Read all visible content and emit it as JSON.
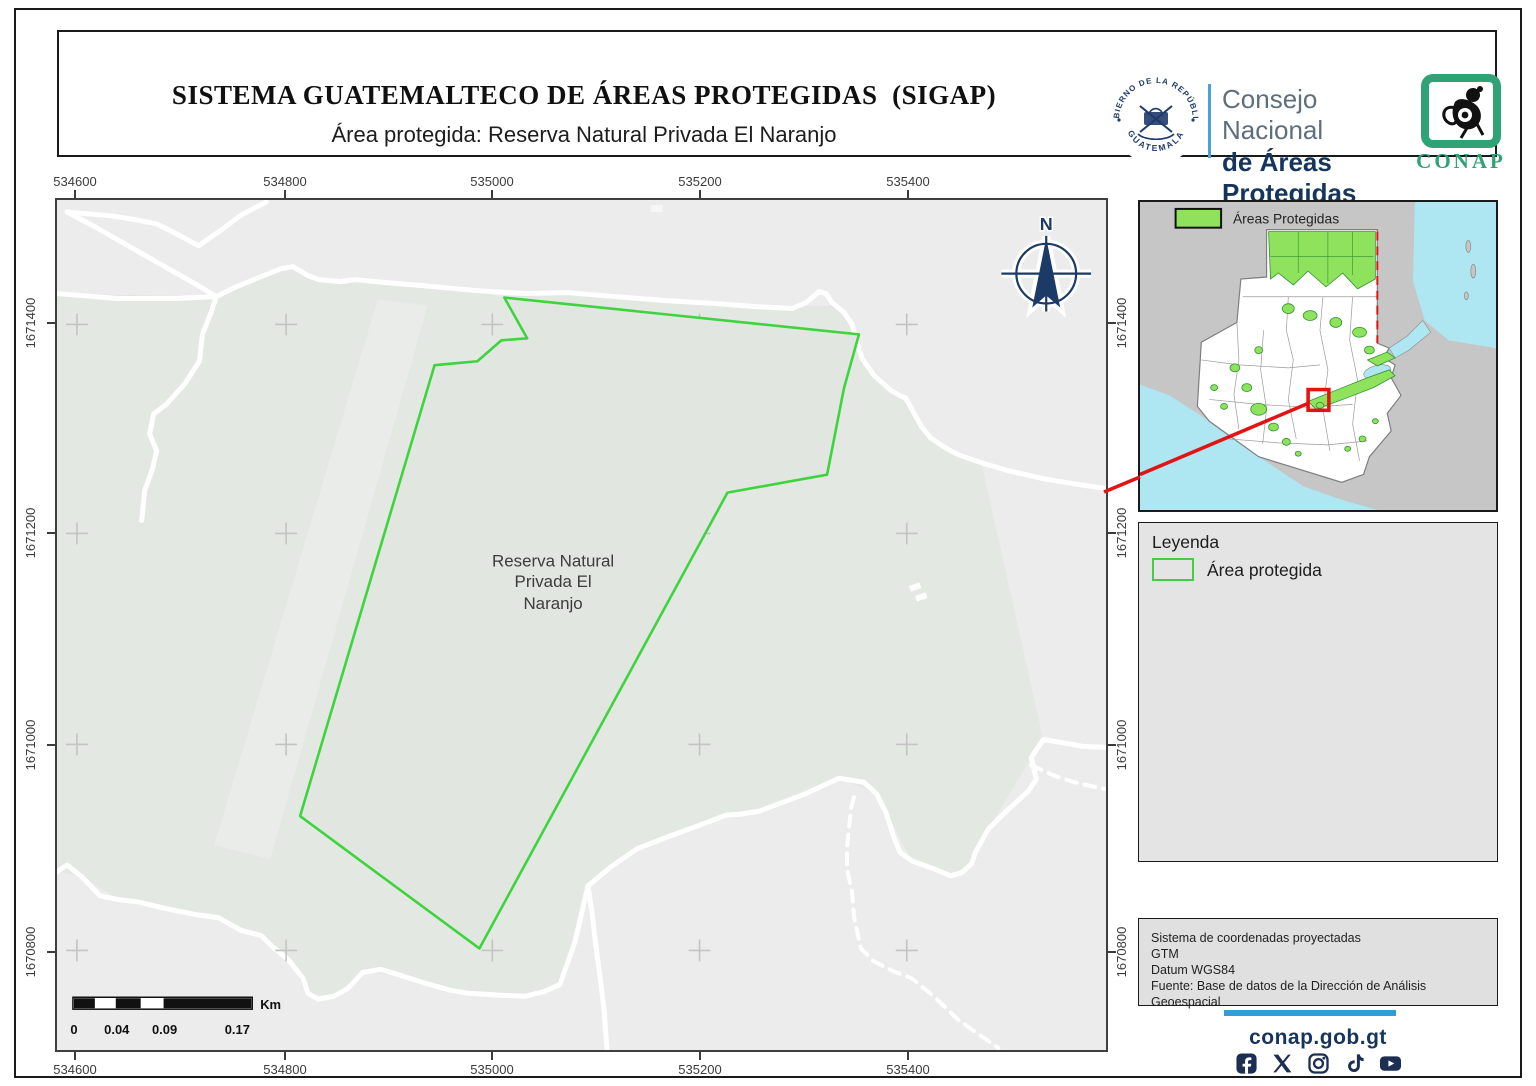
{
  "header": {
    "title": "SISTEMA GUATEMALTECO DE ÁREAS PROTEGIDAS  (SIGAP)",
    "subtitle": "Área protegida: Reserva Natural Privada El Naranjo",
    "seal": {
      "top": "GOBIERNO DE LA REPÚBLICA",
      "bottom": "GUATEMALA"
    },
    "org": {
      "line1": "Consejo Nacional",
      "line2": "de Áreas Protegidas",
      "line3": "Dirección de Análisis Geoespacial"
    },
    "conap": "CONAP"
  },
  "map": {
    "x_ticks": [
      "534600",
      "534800",
      "535000",
      "535200",
      "535400"
    ],
    "y_ticks": [
      "1671400",
      "1671200",
      "1671000",
      "1670800"
    ],
    "reserve_label": {
      "line1": "Reserva Natural",
      "line2": "Privada El",
      "line3": "Naranjo"
    },
    "north": "N",
    "scalebar": {
      "n0": "0",
      "n1": "0.04",
      "n2": "0.09",
      "n3": "0.17",
      "unit": "Km"
    }
  },
  "inset": {
    "legend": "Áreas Protegidas"
  },
  "legend_panel": {
    "title": "Leyenda",
    "item_label": "Área protegida"
  },
  "info_panel": {
    "line1": "Sistema de coordenadas proyectadas",
    "line2": "GTM",
    "line3": "Datum WGS84",
    "line4": "Fuente: Base de datos de la Dirección de Análisis Geoespacial"
  },
  "footer": {
    "website": "conap.gob.gt"
  },
  "colors": {
    "reserve_stroke": "#3dd43d",
    "protected_green": "#8fe35c",
    "marker_red": "#e31313",
    "navy": "#16355c",
    "accent_blue": "#3d9bd1",
    "footer_navy": "#1c2e52",
    "bar_blue": "#2f9fd6"
  }
}
